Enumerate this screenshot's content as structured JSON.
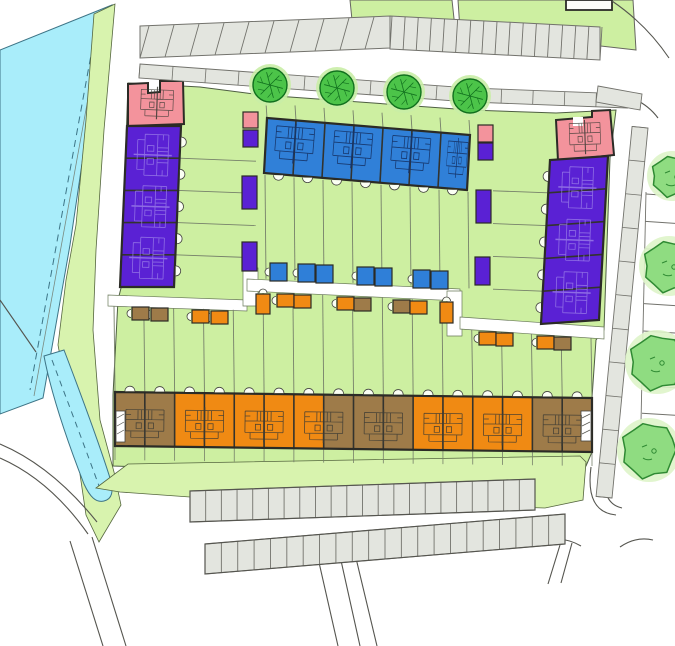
{
  "colors": {
    "background": "#ffffff",
    "water": "#a9edfa",
    "water_line": "#3d7486",
    "verge_green": "#d8f3ae",
    "garden_green": "#cdefa1",
    "green_edge": "#55663f",
    "blue_house": "#3080d8",
    "blue_shed": "#2f7fd8",
    "blue_plan": "#17356a",
    "purple_house": "#5a21d4",
    "purple_plan": "#9b7fe8",
    "pink_house": "#f3939c",
    "orange_house": "#f08a13",
    "brown_house": "#9e7b49",
    "plan_line": "#3e3c34",
    "outline": "#2b2b26",
    "divider": "#33332e",
    "fence_line": "#76806a",
    "road_line": "#55554f",
    "paving_fill": "#e3e5df",
    "paving_stroke": "#72726c",
    "path_fill": "#ffffff",
    "door_arc_fill": "#fbfff4",
    "tree_fill": "#4cc449",
    "tree_stroke": "#11701e",
    "tree_halo": "#c9eda6",
    "tree_light_fill": "#8fdc81",
    "tree_light_stroke": "#2f8a33",
    "tree_light_halo": "#def4c9"
  },
  "buildings": {
    "blue_terrace": {
      "units": 7
    },
    "west_terrace": {
      "pink_units": 1,
      "purple_units": 5
    },
    "east_terrace": {
      "pink_units": 1,
      "purple_units": 5
    },
    "south_terrace": {
      "units": 16,
      "unit_colors": [
        "brown",
        "brown",
        "orange",
        "orange",
        "orange",
        "orange",
        "orange",
        "brown",
        "brown",
        "brown",
        "orange",
        "orange",
        "orange",
        "orange",
        "brown",
        "brown"
      ]
    }
  },
  "sheds": {
    "garden_north": [
      {
        "x": 270,
        "y": 263
      },
      {
        "x": 298,
        "y": 264
      },
      {
        "x": 316,
        "y": 265
      },
      {
        "x": 357,
        "y": 267
      },
      {
        "x": 375,
        "y": 268
      },
      {
        "x": 413,
        "y": 270
      },
      {
        "x": 431,
        "y": 271
      }
    ],
    "garden_south": [
      {
        "x": 132,
        "y": 307,
        "c": "brown"
      },
      {
        "x": 151,
        "y": 308,
        "c": "brown"
      },
      {
        "x": 192,
        "y": 310,
        "c": "orange"
      },
      {
        "x": 211,
        "y": 311,
        "c": "orange"
      },
      {
        "x": 256,
        "y": 294,
        "c": "orange",
        "w": 14,
        "h": 20
      },
      {
        "x": 277,
        "y": 294,
        "c": "orange"
      },
      {
        "x": 294,
        "y": 295,
        "c": "orange"
      },
      {
        "x": 337,
        "y": 297,
        "c": "orange"
      },
      {
        "x": 354,
        "y": 298,
        "c": "brown"
      },
      {
        "x": 393,
        "y": 300,
        "c": "brown"
      },
      {
        "x": 410,
        "y": 301,
        "c": "orange"
      },
      {
        "x": 440,
        "y": 302,
        "c": "orange",
        "w": 13,
        "h": 21
      },
      {
        "x": 479,
        "y": 332,
        "c": "orange"
      },
      {
        "x": 496,
        "y": 333,
        "c": "orange"
      },
      {
        "x": 537,
        "y": 336,
        "c": "orange"
      },
      {
        "x": 554,
        "y": 337,
        "c": "brown"
      }
    ],
    "west_column": [
      {
        "x": 243,
        "y": 112,
        "w": 15,
        "h": 16,
        "c": "pink"
      },
      {
        "x": 243,
        "y": 130,
        "w": 15,
        "h": 17,
        "c": "purple"
      },
      {
        "x": 242,
        "y": 176,
        "w": 15,
        "h": 33,
        "c": "purple"
      },
      {
        "x": 242,
        "y": 242,
        "w": 15,
        "h": 29,
        "c": "purple"
      }
    ],
    "east_column": [
      {
        "x": 478,
        "y": 125,
        "w": 15,
        "h": 17,
        "c": "pink"
      },
      {
        "x": 478,
        "y": 143,
        "w": 15,
        "h": 17,
        "c": "purple"
      },
      {
        "x": 476,
        "y": 190,
        "w": 15,
        "h": 33,
        "c": "purple"
      },
      {
        "x": 475,
        "y": 257,
        "w": 15,
        "h": 28,
        "c": "purple"
      }
    ]
  },
  "trees": {
    "street": [
      {
        "x": 270,
        "y": 85,
        "r": 17
      },
      {
        "x": 337,
        "y": 88,
        "r": 17
      },
      {
        "x": 404,
        "y": 92,
        "r": 17
      },
      {
        "x": 470,
        "y": 96,
        "r": 17
      }
    ],
    "right_edge": [
      {
        "x": 672,
        "y": 176,
        "r": 20
      },
      {
        "x": 669,
        "y": 266,
        "r": 25
      },
      {
        "x": 657,
        "y": 362,
        "r": 27
      },
      {
        "x": 649,
        "y": 450,
        "r": 27
      }
    ]
  },
  "parking": {
    "top_west_stalls": 10,
    "top_east_stalls": 16,
    "south_upper_stalls": 22,
    "south_lower_stalls": 22,
    "right_edge_stalls": 10
  },
  "walkways": {
    "north_segments": 15,
    "east_segments": 11
  }
}
